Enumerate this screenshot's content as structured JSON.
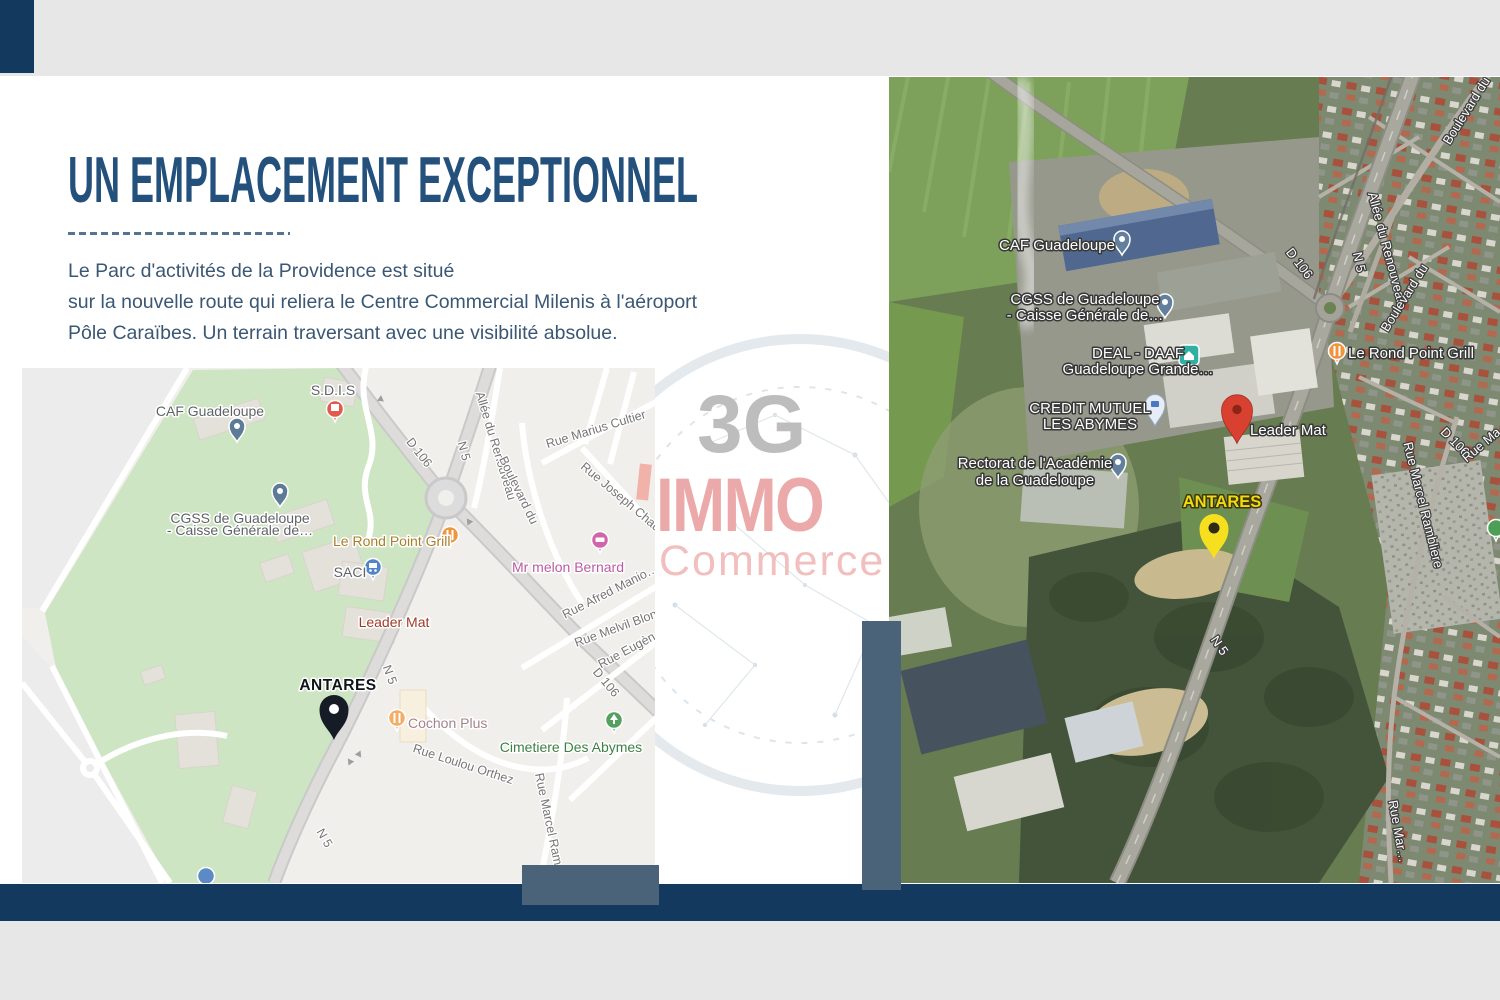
{
  "slide": {
    "title": "UN EMPLACEMENT EXCEPTIONNEL",
    "paragraph_lines": [
      "Le Parc d'activités de la Providence est situé",
      "sur la nouvelle route qui reliera le Centre Commercial Milenis à l'aéroport",
      "Pôle Caraïbes. Un terrain traversant avec une visibilité absolue."
    ]
  },
  "watermark": {
    "top": "3G",
    "middle": "IMMO",
    "bottom": "Commerce"
  },
  "street_map": {
    "place_labels": [
      {
        "text": "CAF Guadeloupe"
      },
      {
        "text": "S.D.I.S"
      },
      {
        "text": "CGSS de Guadeloupe"
      },
      {
        "text": "- Caisse Générale de…"
      },
      {
        "text": "Le Rond Point Grill"
      },
      {
        "text": "SACI"
      },
      {
        "text": "Leader Mat"
      },
      {
        "text": "ANTARES"
      },
      {
        "text": "Cochon Plus"
      },
      {
        "text": "Cimetiere Des Abymes"
      },
      {
        "text": "Mr melon Bernard"
      }
    ],
    "road_labels": [
      "D 106",
      "N 5",
      "Allée du Renouveau",
      "Boulevard du",
      "Rue Marius Cultier",
      "Rue Joseph Chau…",
      "Rue Afred Manio…",
      "Rue Melvil Blon…",
      "Rue Eugèn…",
      "N 5",
      "Rue Loulou Orthez",
      "Rue Marcel Ram…",
      "D 106",
      "N 5"
    ]
  },
  "satellite_map": {
    "place_labels": [
      {
        "text": "CAF Guadeloupe"
      },
      {
        "text": "CGSS de Guadeloupe"
      },
      {
        "text": "- Caisse Générale de…"
      },
      {
        "text": "DEAL - DAAF"
      },
      {
        "text": "Guadeloupe Grande…"
      },
      {
        "text": "CREDIT MUTUEL"
      },
      {
        "text": "LES ABYMES"
      },
      {
        "text": "Rectorat de l'Académie"
      },
      {
        "text": "de la Guadeloupe"
      },
      {
        "text": "Leader Mat"
      },
      {
        "text": "ANTARES"
      },
      {
        "text": "Le Rond Point Grill"
      }
    ],
    "road_labels": [
      "D 106",
      "N 5",
      "Allée du Renouveau",
      "Boulevard du",
      "Boulevard du",
      "D 106",
      "Rue Marcel Rambliere",
      "N 5",
      "Rue Mar…",
      "Rue Ma…"
    ]
  },
  "map_icons": {
    "antares_pin_street": "large-black-map-pin",
    "antares_pin_satellite": "large-yellow-map-pin",
    "leader_mat_pin": "red-marker-pin",
    "poi_restaurant": "orange-circle-fork-knife",
    "poi_cemetery": "green-circle-tree",
    "poi_hotel": "pink-circle-bed",
    "poi_store": "blue-circle-cart",
    "poi_fire_station": "red-circle-building",
    "poi_bank": "teal-square-bank",
    "poi_generic": "slate-circle-dot"
  },
  "colors": {
    "band_gray": "#E7E7E7",
    "accent_navy": "#14395E",
    "accent_slate": "#4B6378",
    "title_blue": "#23517C",
    "body_text": "#3A5773",
    "watermark_gray": "#BDBDBD",
    "watermark_pink": "#ECA9A9",
    "watermark_pink_light": "#F2BFBF",
    "pin_black": "#161C26",
    "pin_yellow": "#F6DF1E",
    "pin_red": "#D8402F",
    "map_green": "#CDE5C2",
    "antares_label_yellow": "#F2D916"
  }
}
